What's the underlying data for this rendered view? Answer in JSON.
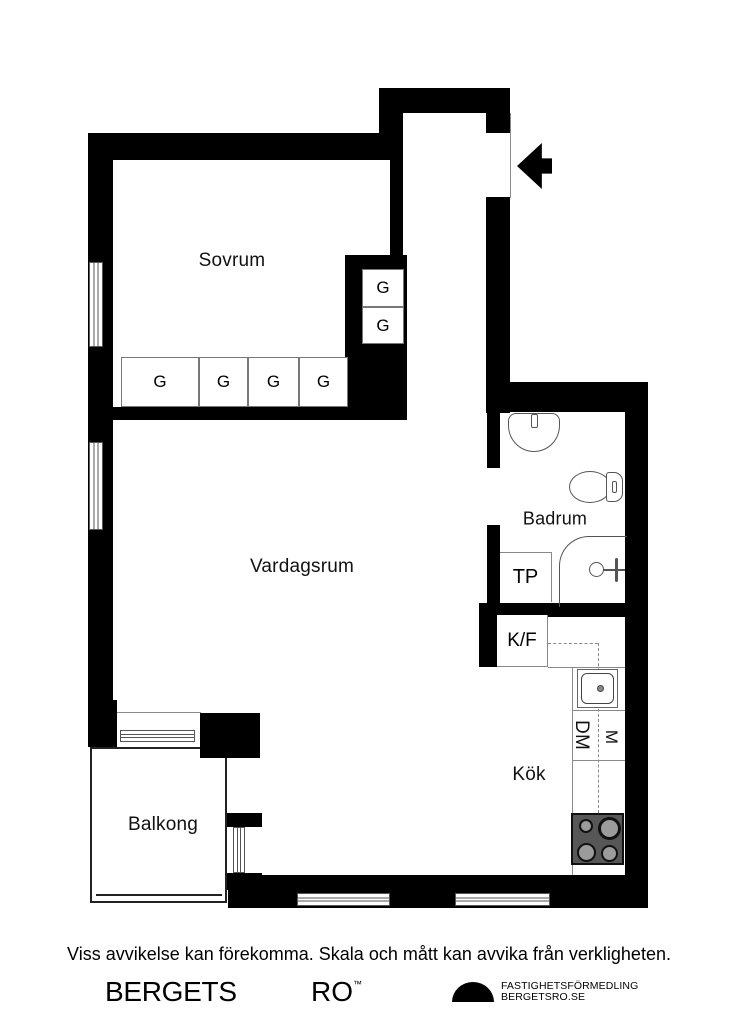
{
  "plan": {
    "rooms": {
      "bedroom": "Sovrum",
      "living_room": "Vardagsrum",
      "bathroom": "Badrum",
      "kitchen": "Kök",
      "balcony": "Balkong"
    },
    "labels": {
      "tp_closet": "TP",
      "fridge_freezer": "K/F",
      "dishwasher": "DM",
      "micro": "M"
    },
    "wardrobes": {
      "row": [
        "G",
        "G",
        "G",
        "G"
      ],
      "stack": [
        "G",
        "G"
      ]
    },
    "icons": {
      "entry_arrow": "arrow-left-icon"
    },
    "colors": {
      "wall": "#000000",
      "thin_line": "#8a8a8a",
      "stove_body": "#575757",
      "burner_fill": "#9b9b9b"
    }
  },
  "footer": {
    "disclaimer": "Viss avvikelse kan förekomma. Skala och mått kan avvika från verkligheten.",
    "brand_word1": "BERGETS",
    "brand_word2": "RO",
    "trademark": "™",
    "agency_line1": "FASTIGHETSFÖRMEDLING",
    "agency_line2": "BERGETSRO.SE"
  }
}
